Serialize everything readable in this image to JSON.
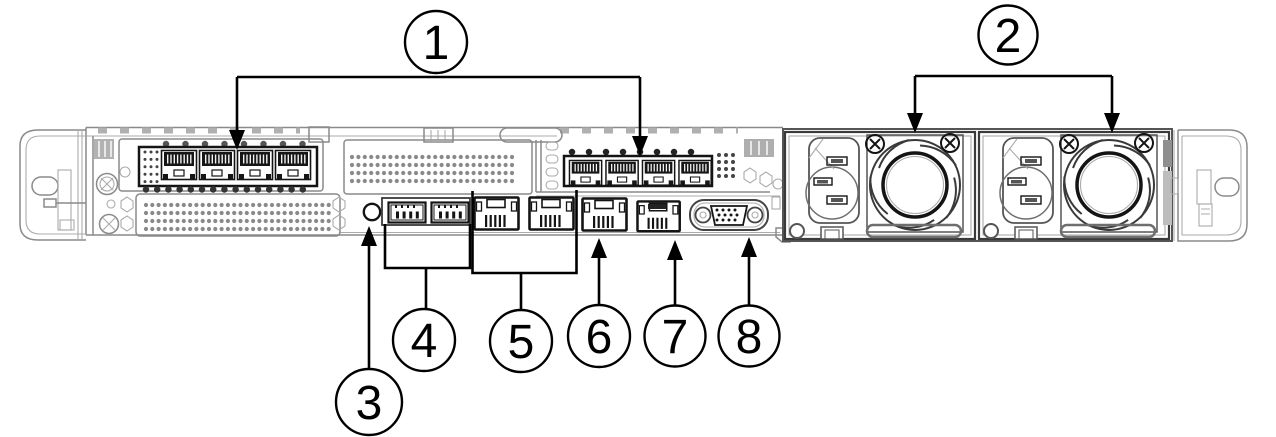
{
  "diagram": {
    "type": "server-rear-view",
    "callouts": [
      {
        "number": "1",
        "label": "network-adapter-ethernet-ports"
      },
      {
        "number": "2",
        "label": "power-supply-units"
      },
      {
        "number": "3",
        "label": "identification-button"
      },
      {
        "number": "4",
        "label": "usb-ports"
      },
      {
        "number": "5",
        "label": "ethernet-ports"
      },
      {
        "number": "6",
        "label": "ethernet-port"
      },
      {
        "number": "7",
        "label": "dedicated-management-port"
      },
      {
        "number": "8",
        "label": "vga-port"
      }
    ],
    "colors": {
      "background": "#ffffff",
      "chassis_line": "#8a8a8a",
      "port_line": "#141414",
      "callout": "#000000"
    }
  }
}
